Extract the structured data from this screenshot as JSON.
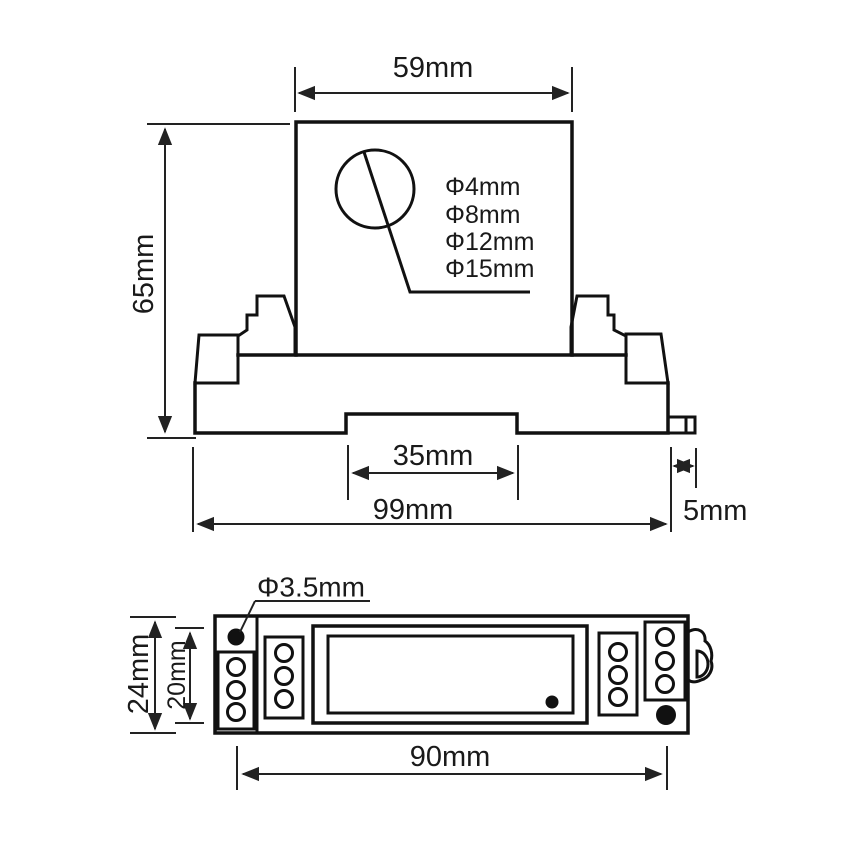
{
  "drawing_title": "device-dimension-drawing",
  "colors": {
    "background": "#ffffff",
    "outline": "#111111",
    "dimension_line": "#222222",
    "text": "#1a1a1a"
  },
  "front_view": {
    "width_label": "59mm",
    "height_label": "65mm",
    "rail_slot_label": "35mm",
    "total_width_label": "99mm",
    "tab_label": "5mm",
    "aperture_labels": [
      "Φ4mm",
      "Φ8mm",
      "Φ12mm",
      "Φ15mm"
    ]
  },
  "top_view": {
    "hole_label": "Φ3.5mm",
    "outer_height_label": "24mm",
    "inner_height_label": "20mm",
    "hole_spacing_label": "90mm"
  }
}
